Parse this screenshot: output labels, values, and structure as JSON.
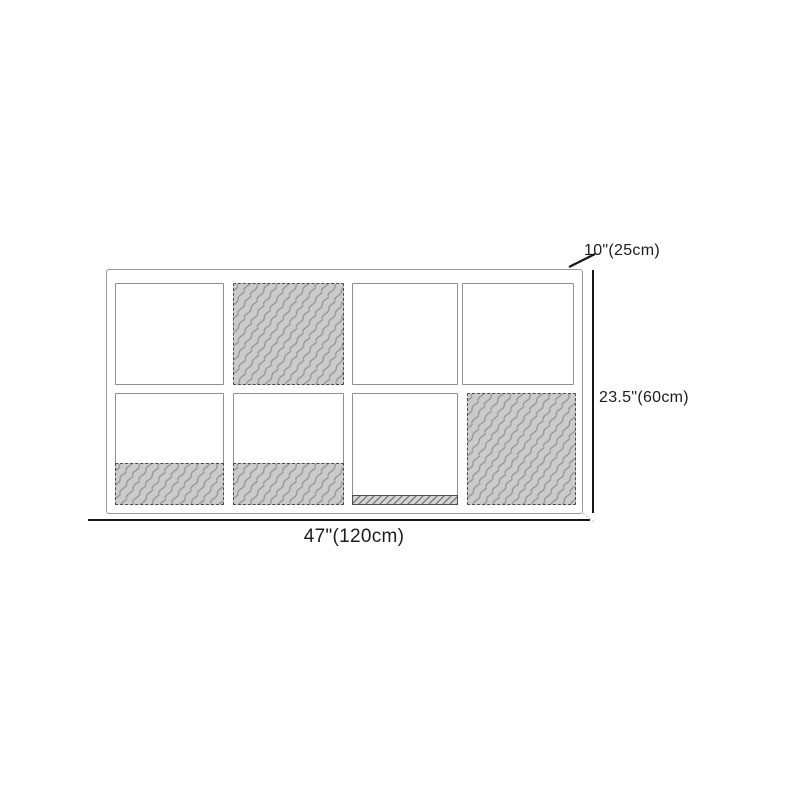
{
  "diagram": {
    "kind": "product-dimension-diagram",
    "product": "8-cube storage shelf, front view"
  },
  "dimensions": {
    "depth": "10\"(25cm)",
    "height": "23.5\"(60cm)",
    "width": "47\"(120cm)"
  },
  "cabinet": {
    "rows": 2,
    "columns": 4,
    "cells": [
      {
        "row": 1,
        "col": 1,
        "fill": "open"
      },
      {
        "row": 1,
        "col": 2,
        "fill": "textured-full"
      },
      {
        "row": 1,
        "col": 3,
        "fill": "open"
      },
      {
        "row": 1,
        "col": 4,
        "fill": "open"
      },
      {
        "row": 2,
        "col": 1,
        "fill": "textured-bottom"
      },
      {
        "row": 2,
        "col": 2,
        "fill": "textured-bottom"
      },
      {
        "row": 2,
        "col": 3,
        "fill": "bottom-strip"
      },
      {
        "row": 2,
        "col": 4,
        "fill": "textured-full"
      }
    ]
  },
  "colors": {
    "line": "#161616",
    "text": "#1c1c1c",
    "frame_border": "#9a9a9a",
    "cell_border": "#8f8f8f",
    "texture_fill": "#cbcbcb",
    "texture_stroke": "#979797",
    "texture_border": "#4a4a4a",
    "hatch_fill": "#d4d4d4",
    "hatch_stroke": "#6f6f6f"
  }
}
